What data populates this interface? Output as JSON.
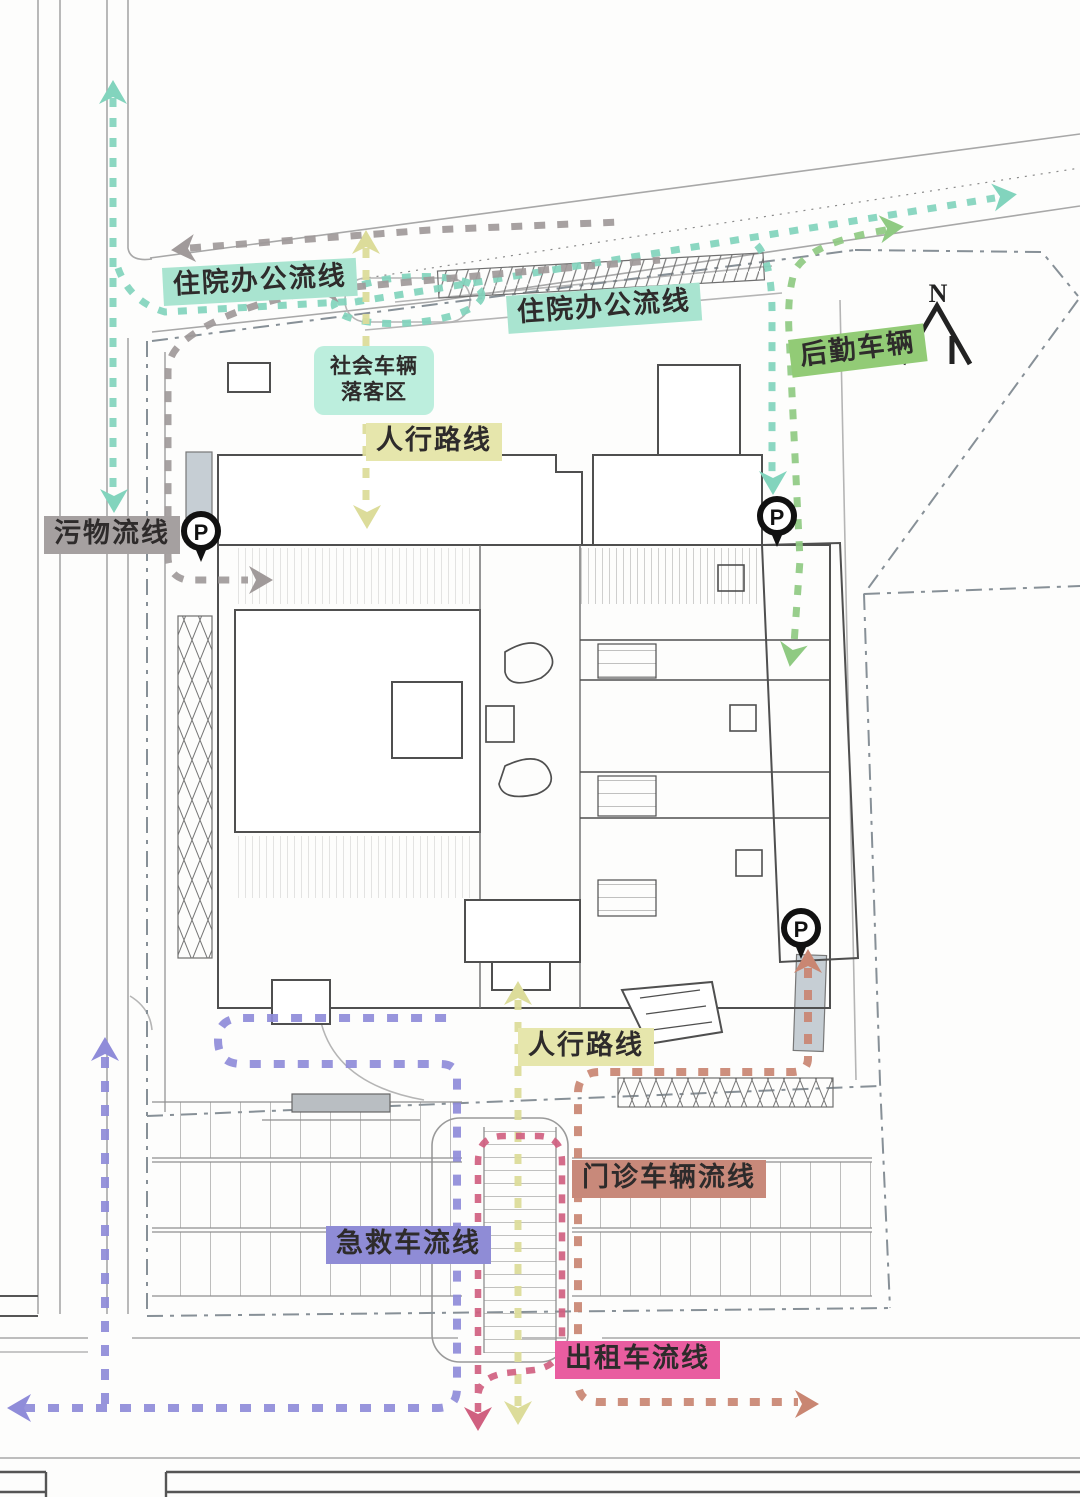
{
  "labels": {
    "inpatient_office_1": "住院办公流线",
    "inpatient_office_2": "住院办公流线",
    "dropoff_line1": "社会车辆",
    "dropoff_line2": "落客区",
    "pedestrian_top": "人行路线",
    "pedestrian_bottom": "人行路线",
    "logistics": "后勤车辆",
    "waste": "污物流线",
    "outpatient": "门诊车辆流线",
    "ambulance": "急救车流线",
    "taxi": "出租车流线"
  },
  "symbols": {
    "parking": "P",
    "north": "N"
  },
  "colors": {
    "teal_flow": "#82d4bd",
    "teal_label_bg": "#a9e4d0",
    "mint_dropoff_bg": "#bceedd",
    "green_flow": "#8fca82",
    "green_label_bg": "#92cb76",
    "yellow_flow": "#dcdc9a",
    "yellow_label_bg": "#e6e6ac",
    "gray_flow": "#a09a9a",
    "gray_label_bg": "#a5a0a0",
    "purple_flow": "#8f8cd9",
    "purple_label_bg": "#8f8cd6",
    "pink_flow": "#d06080",
    "magenta_label_bg": "#e95da0",
    "salmon_flow": "#c98672",
    "salmon_label_bg": "#c8897a"
  }
}
